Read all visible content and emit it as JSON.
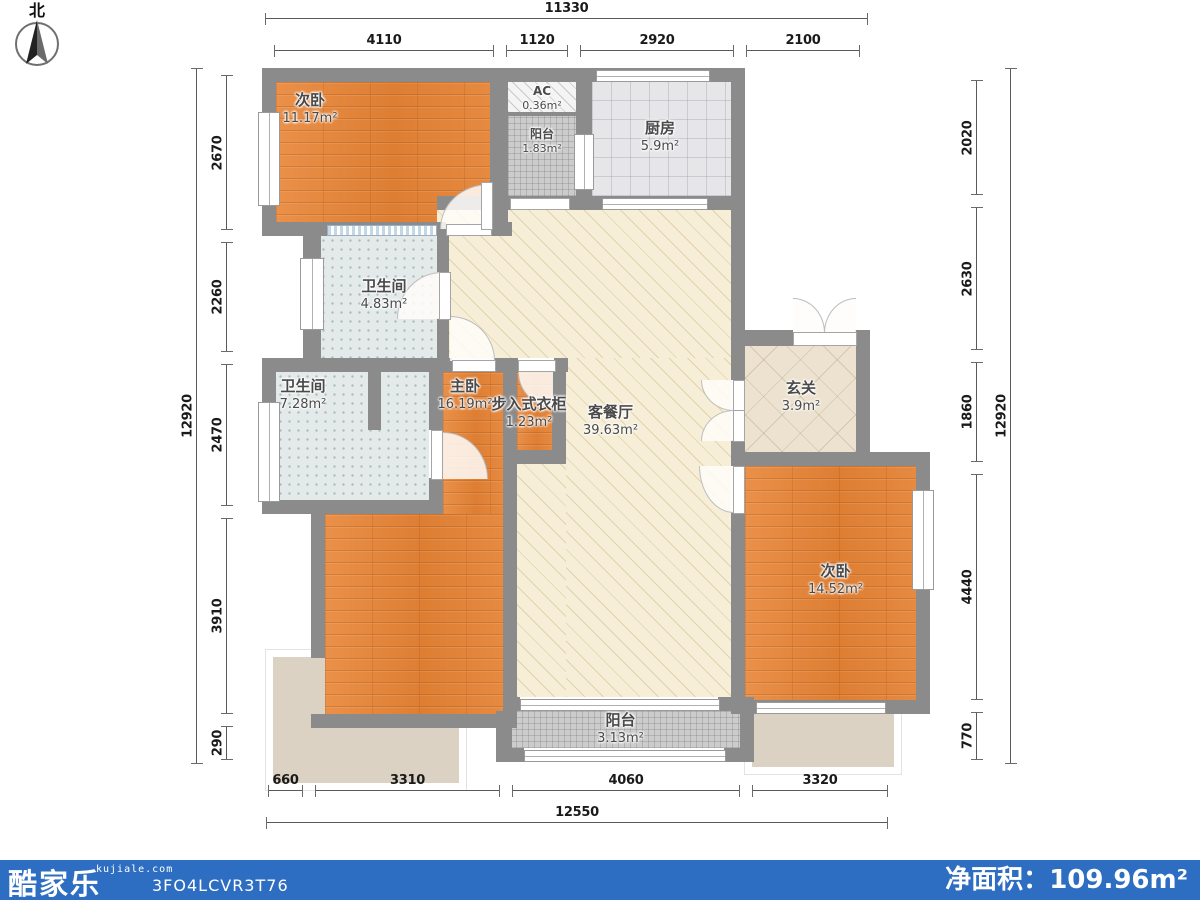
{
  "compass": {
    "label": "北"
  },
  "rooms": [
    {
      "id": "bedroom-top-left",
      "name": "次卧",
      "area": "11.17m²"
    },
    {
      "id": "ac",
      "name": "AC",
      "area": "0.36m²"
    },
    {
      "id": "balcony-top",
      "name": "阳台",
      "area": "1.83m²"
    },
    {
      "id": "kitchen",
      "name": "厨房",
      "area": "5.9m²"
    },
    {
      "id": "bathroom-1",
      "name": "卫生间",
      "area": "4.83m²"
    },
    {
      "id": "bathroom-2",
      "name": "卫生间",
      "area": "7.28m²"
    },
    {
      "id": "master-bedroom",
      "name": "主卧",
      "area": "16.19m²"
    },
    {
      "id": "walkin-closet",
      "name": "步入式衣柜",
      "area": "1.23m²"
    },
    {
      "id": "living-dining",
      "name": "客餐厅",
      "area": "39.63m²"
    },
    {
      "id": "entry-hall",
      "name": "玄关",
      "area": "3.9m²"
    },
    {
      "id": "bedroom-right",
      "name": "次卧",
      "area": "14.52m²"
    },
    {
      "id": "balcony-bottom",
      "name": "阳台",
      "area": "3.13m²"
    }
  ],
  "dimensions": {
    "top": {
      "overall": "11330",
      "segments": [
        "4110",
        "1120",
        "2920",
        "2100"
      ]
    },
    "bottom": {
      "overall": "12550",
      "segments": [
        "660",
        "3310",
        "4060",
        "3320"
      ]
    },
    "left": {
      "overall": "12920",
      "segments": [
        "2670",
        "2260",
        "2470",
        "3910",
        "290"
      ]
    },
    "right": {
      "overall": "12920",
      "segments": [
        "2020",
        "2630",
        "1860",
        "4440",
        "770"
      ]
    }
  },
  "footer": {
    "brand": "酷家乐",
    "website": "kujiale.com",
    "code": "3FO4LCVR3T76",
    "net_area_label": "净面积：",
    "net_area_value": "109.96m²",
    "bar_color": "#2e6ec2"
  }
}
